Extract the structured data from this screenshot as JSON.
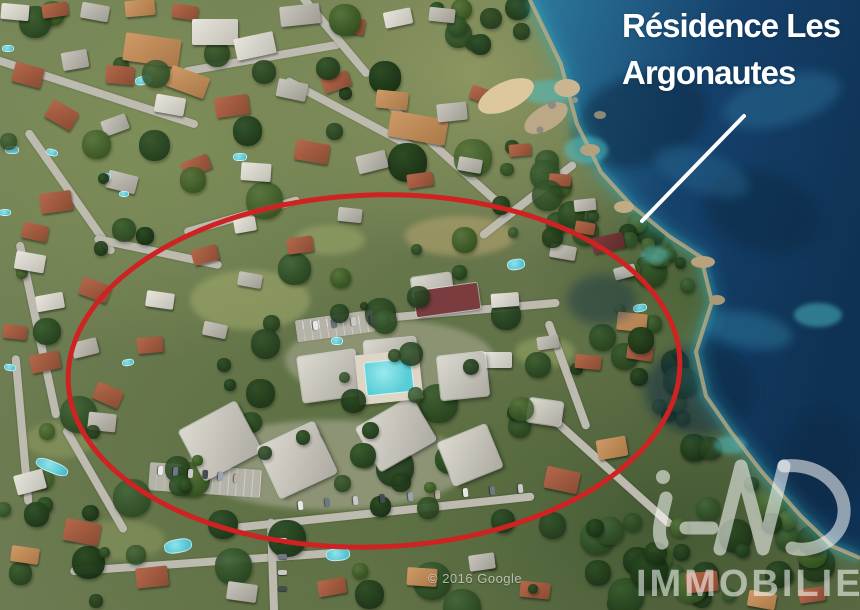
{
  "annotation": {
    "title_line1": "Résidence Les",
    "title_line2": "Argonautes"
  },
  "watermark": {
    "copyright": "© 2016 Google"
  },
  "brand": {
    "logo_text": "iAD",
    "logo_subtext": "IMMOBILIER"
  },
  "palette": {
    "highlight_red": "#cf2222",
    "annotation_white": "#ffffff",
    "sea_shore": "#2e7a9e",
    "sea_mid": "#15416b",
    "sea_deep": "#0f3153",
    "sea_shallow": "#39a8b5",
    "shore_rock": "#c3ad83",
    "land_base": "#6a7a4c",
    "tree_dark": "#27451f",
    "road_gray": "#bdbab0",
    "roof_terracotta": "#b5684a",
    "building_light": "#d4d1c9",
    "pool_teal": "#58cdd6",
    "court_maroon": "#7b3c40",
    "logo_white_alpha": "rgba(255,255,255,0.55)"
  }
}
